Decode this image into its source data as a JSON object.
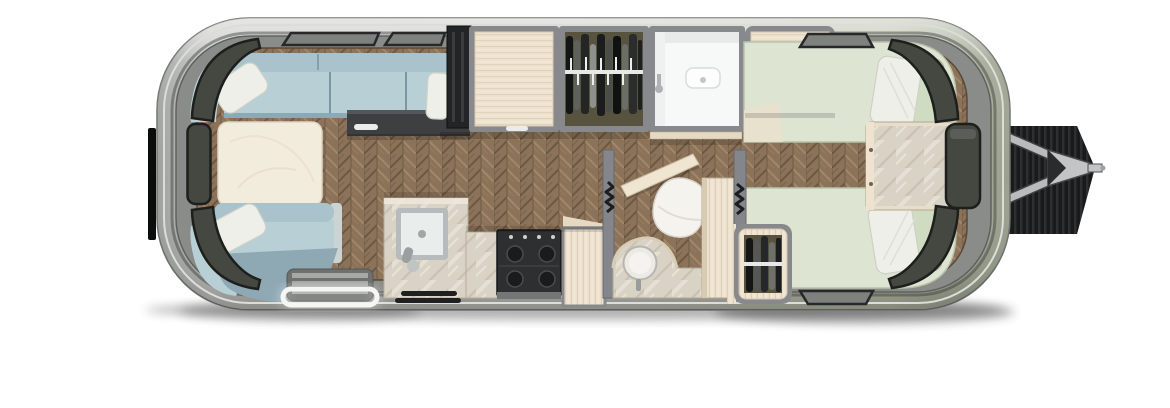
{
  "meta": {
    "description": "Top-down interior floor plan rendering of a travel trailer; image contains no visible text",
    "view": "floorplan-top-view",
    "canvas": {
      "width": 1170,
      "height": 408
    }
  },
  "colors": {
    "canvas_bg": "#ffffff",
    "shell_silver": "#c8c9c5",
    "shell_sage": "#bfc3ae",
    "shell_edge": "#717370",
    "wall_band": "#8a8c89",
    "floor_wood": "#8b7258",
    "floor_wood_dark": "#6c5843",
    "floor_wood_light": "#a1876a",
    "window_glass": "#454841",
    "window_frame": "#1d1f1d",
    "sofa": "#b9cfd6",
    "sofa_back": "#a9c2cb",
    "sofa_shade": "#8fa9b4",
    "pillow": "#edefe8",
    "table": "#f2ecdd",
    "bed": "#dde5d2",
    "bed_bolster": "#cfdcc2",
    "marble": "#d9d3c6",
    "wood_light": "#eee2d0",
    "cabinet_frame": "#87898c",
    "fridge": "#232425",
    "stove": "#2d2f31",
    "burner": "#1a1b1c",
    "closet_dark": "#57533f",
    "shower_white": "#f7f8f8",
    "step_gray": "#6f7170",
    "step_trim": "#f3f3f1",
    "credenza_dark": "#3e3f40",
    "handle_white": "#eaecea",
    "hitch_silver": "#c2c4c6",
    "hitch_shadow": "#17181a",
    "bumper_black": "#0b0c0c"
  },
  "features": [
    "trailer-shell",
    "hitch-tongue",
    "rear-bumper",
    "wraparound-dinette-sofa",
    "dinette-table",
    "throw-pillows",
    "refrigerator",
    "overhead-cabinet",
    "hanging-wardrobe-upper",
    "shower-stall",
    "galley-sink",
    "cooktop-stove",
    "entry-step",
    "grab-handles",
    "bathroom-door",
    "toilet",
    "vanity-sink",
    "hanging-wardrobe-lower",
    "twin-bed-upper",
    "twin-bed-lower",
    "nightstand",
    "panoramic-windows"
  ]
}
